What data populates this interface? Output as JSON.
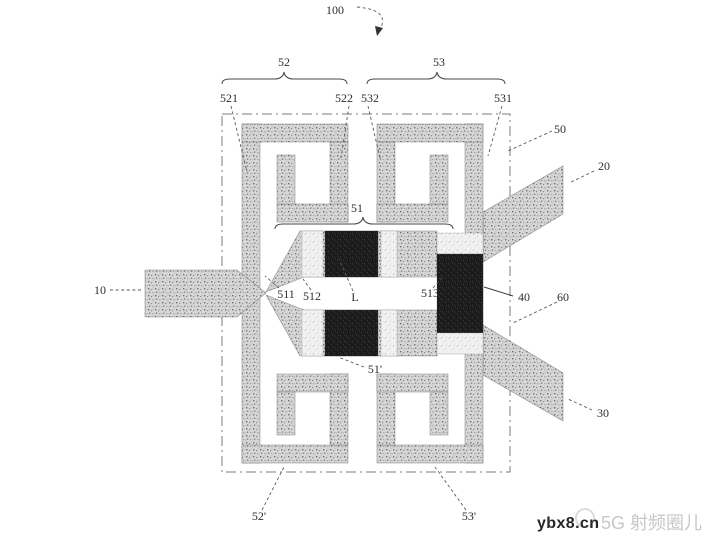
{
  "figure": {
    "kind": "patent-figure",
    "description": "Microstrip power-divider / filter structure with four square spiral resonators, coupled-line section, feed line and two output lines"
  },
  "colors": {
    "background": "#ffffff",
    "stipple_metal": "#d7d7d7",
    "stipple_speck": "#6e6e6e",
    "dark_block": "#1b1b1b",
    "light_block": "#f1f1f1",
    "line": "#4a4a4a",
    "label_text": "#2e2e2e",
    "boundary_line": "#7d7d7d",
    "watermark_site": "#262626",
    "watermark_community": "#c7c7c7"
  },
  "labels": [
    {
      "id": "100",
      "text": "100",
      "x": 335,
      "y": 14
    },
    {
      "id": "52",
      "text": "52",
      "x": 284,
      "y": 66
    },
    {
      "id": "53",
      "text": "53",
      "x": 439,
      "y": 66
    },
    {
      "id": "521",
      "text": "521",
      "x": 229,
      "y": 102
    },
    {
      "id": "522",
      "text": "522",
      "x": 344,
      "y": 102
    },
    {
      "id": "532",
      "text": "532",
      "x": 370,
      "y": 102
    },
    {
      "id": "531",
      "text": "531",
      "x": 503,
      "y": 102
    },
    {
      "id": "50",
      "text": "50",
      "x": 560,
      "y": 133
    },
    {
      "id": "20",
      "text": "20",
      "x": 604,
      "y": 170
    },
    {
      "id": "51",
      "text": "51",
      "x": 357,
      "y": 212
    },
    {
      "id": "10",
      "text": "10",
      "x": 100,
      "y": 294
    },
    {
      "id": "511",
      "text": "511",
      "x": 286,
      "y": 298
    },
    {
      "id": "512",
      "text": "512",
      "x": 312,
      "y": 300
    },
    {
      "id": "L",
      "text": "L",
      "x": 355,
      "y": 301
    },
    {
      "id": "513",
      "text": "513",
      "x": 430,
      "y": 297
    },
    {
      "id": "40",
      "text": "40",
      "x": 524,
      "y": 301
    },
    {
      "id": "60",
      "text": "60",
      "x": 563,
      "y": 301
    },
    {
      "id": "51p",
      "text": "51'",
      "x": 375,
      "y": 373
    },
    {
      "id": "30",
      "text": "30",
      "x": 603,
      "y": 417
    },
    {
      "id": "52p",
      "text": "52'",
      "x": 259,
      "y": 520
    },
    {
      "id": "53p",
      "text": "53'",
      "x": 469,
      "y": 520
    }
  ],
  "leaders": [
    {
      "for": "521",
      "x1": 231,
      "y1": 106,
      "x2": 247,
      "y2": 172,
      "style": "dashed"
    },
    {
      "for": "522",
      "x1": 349,
      "y1": 106,
      "x2": 341,
      "y2": 158,
      "style": "dashed"
    },
    {
      "for": "532",
      "x1": 368,
      "y1": 106,
      "x2": 380,
      "y2": 158,
      "style": "dashed"
    },
    {
      "for": "531",
      "x1": 502,
      "y1": 106,
      "x2": 488,
      "y2": 156,
      "style": "dashed"
    },
    {
      "for": "50",
      "x1": 552,
      "y1": 131,
      "x2": 508,
      "y2": 151,
      "style": "dashed"
    },
    {
      "for": "20",
      "x1": 594,
      "y1": 171,
      "x2": 569,
      "y2": 183,
      "style": "dashed"
    },
    {
      "for": "10",
      "x1": 110,
      "y1": 290,
      "x2": 143,
      "y2": 290,
      "style": "dashed"
    },
    {
      "for": "511",
      "x1": 279,
      "y1": 288,
      "x2": 265,
      "y2": 276,
      "style": "dashed"
    },
    {
      "for": "512",
      "x1": 311,
      "y1": 290,
      "x2": 303,
      "y2": 279,
      "style": "dashed"
    },
    {
      "for": "L",
      "x1": 353,
      "y1": 291,
      "x2": 339,
      "y2": 259,
      "style": "dashed"
    },
    {
      "for": "513",
      "x1": 433,
      "y1": 288,
      "x2": 442,
      "y2": 278,
      "style": "dashed"
    },
    {
      "for": "40",
      "x1": 513,
      "y1": 296,
      "x2": 484,
      "y2": 287,
      "style": "solid"
    },
    {
      "for": "60",
      "x1": 557,
      "y1": 302,
      "x2": 513,
      "y2": 323,
      "style": "dashed"
    },
    {
      "for": "51p",
      "x1": 364,
      "y1": 367,
      "x2": 338,
      "y2": 357,
      "style": "dashed"
    },
    {
      "for": "30",
      "x1": 592,
      "y1": 410,
      "x2": 568,
      "y2": 399,
      "style": "dashed"
    },
    {
      "for": "52p",
      "x1": 262,
      "y1": 510,
      "x2": 284,
      "y2": 467,
      "style": "dashed"
    },
    {
      "for": "53p",
      "x1": 466,
      "y1": 510,
      "x2": 435,
      "y2": 467,
      "style": "dashed"
    }
  ],
  "braces": [
    {
      "for": "52",
      "x1": 222,
      "x2": 347,
      "y": 84,
      "tip_x": 284
    },
    {
      "for": "53",
      "x1": 367,
      "x2": 505,
      "y": 84,
      "tip_x": 437
    },
    {
      "for": "51",
      "x1": 275,
      "x2": 453,
      "y": 229,
      "tip_x": 363
    }
  ],
  "arrow_100": {
    "path": "M357,7 Q392,10 379,31",
    "head": "375,26 383,28 377,36"
  },
  "watermark": {
    "site": "ybx8.cn",
    "community": "5G 射频圈儿"
  }
}
